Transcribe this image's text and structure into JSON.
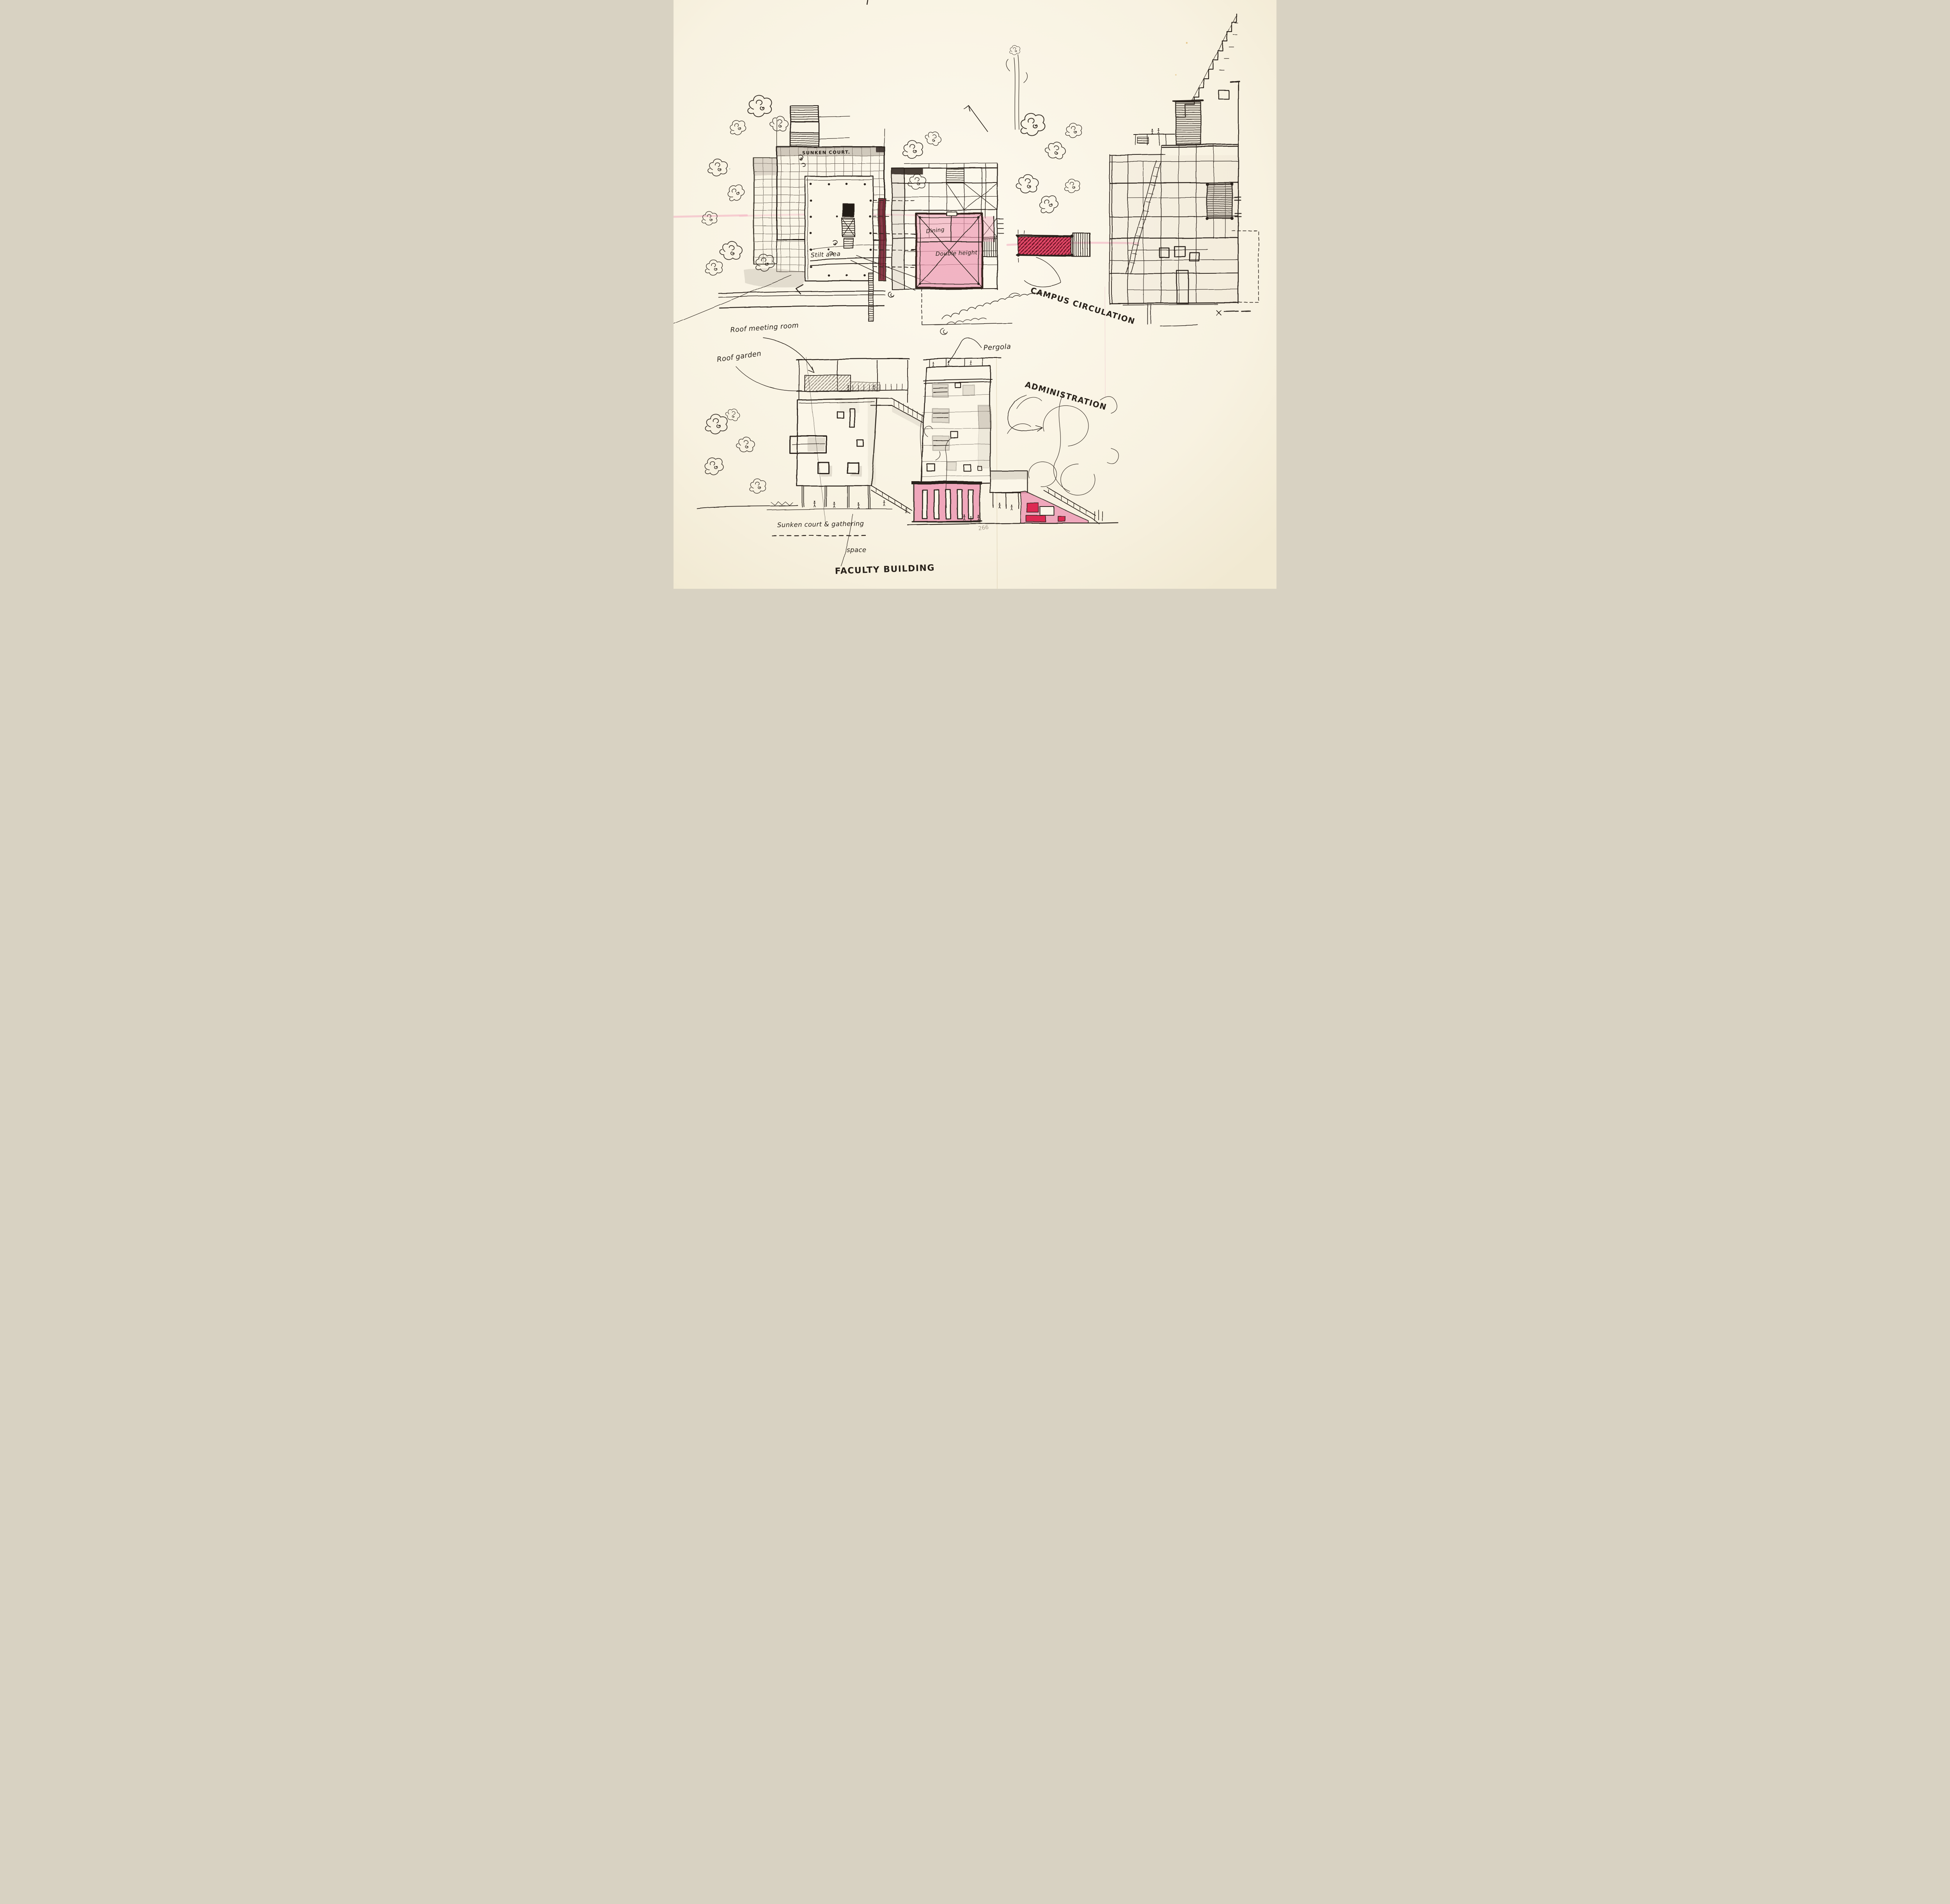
{
  "sketch": {
    "kind": "architectural concept sketch",
    "medium": "ink, grey wash and pink marker on cream sketchbook paper",
    "page_number": "266"
  },
  "palette": {
    "paper": "#f9f4e4",
    "ink": "#2a221b",
    "gray_wash": "#a59c8f",
    "pink_wash": "#ee9cb5",
    "pink_marker": "#f3abc0",
    "red_accent": "#dd2b52",
    "dark_red": "#7c2433",
    "pencil": "#a79d8d"
  },
  "plan_labels": {
    "sunken_court": "SUNKEN COURT.",
    "stilt_area": "Stilt area",
    "dining": "Dining",
    "double_height": "Double height",
    "campus_circulation": "CAMPUS CIRCULATION"
  },
  "elevation_labels": {
    "roof_meeting_room": "Roof meeting room",
    "roof_garden": "Roof garden",
    "pergola": "Pergola",
    "administration": "ADMINISTRATION",
    "gathering_line1": "Sunken court & gathering",
    "gathering_line2": "space",
    "faculty_building": "FACULTY BUILDING",
    "page_number": "266"
  }
}
